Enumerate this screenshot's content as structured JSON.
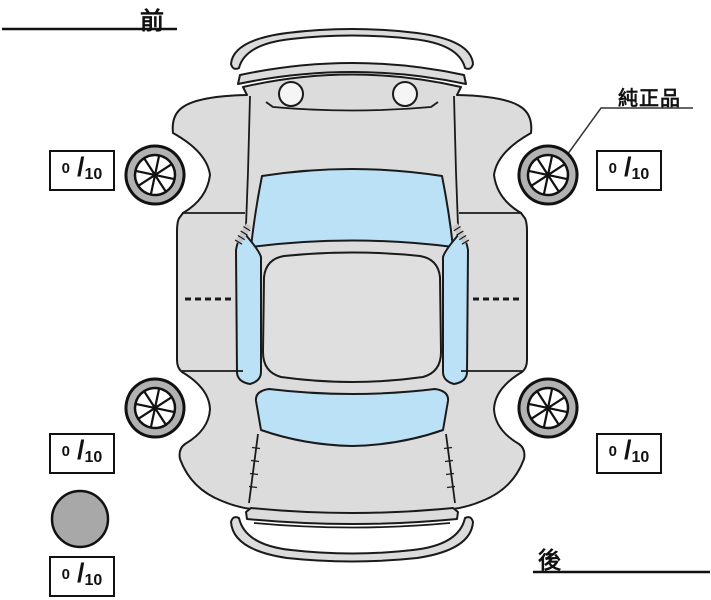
{
  "diagram": {
    "title": "vehicle-top-view-tire-tread-diagram",
    "labels": {
      "front": "前",
      "rear": "後",
      "genuine_part": "純正品",
      "score_separator": "/"
    },
    "tread_scores": {
      "front_left": {
        "value": "0",
        "max": "10"
      },
      "front_right": {
        "value": "0",
        "max": "10"
      },
      "rear_left": {
        "value": "0",
        "max": "10"
      },
      "rear_right": {
        "value": "0",
        "max": "10"
      },
      "spare": {
        "value": "0",
        "max": "10"
      }
    },
    "icons": [
      "wheel-front-left-icon",
      "wheel-front-right-icon",
      "wheel-rear-left-icon",
      "wheel-rear-right-icon",
      "spare-tire-icon"
    ],
    "colors": {
      "background": "#ffffff",
      "car_body": "#dcdcdc",
      "roof": "#dfdfdf",
      "window_glass": "#bbe1f7",
      "tire_ring": "#b2b2b2",
      "spare_tire": "#a8a8a8",
      "outline": "#1a1a1a"
    }
  }
}
